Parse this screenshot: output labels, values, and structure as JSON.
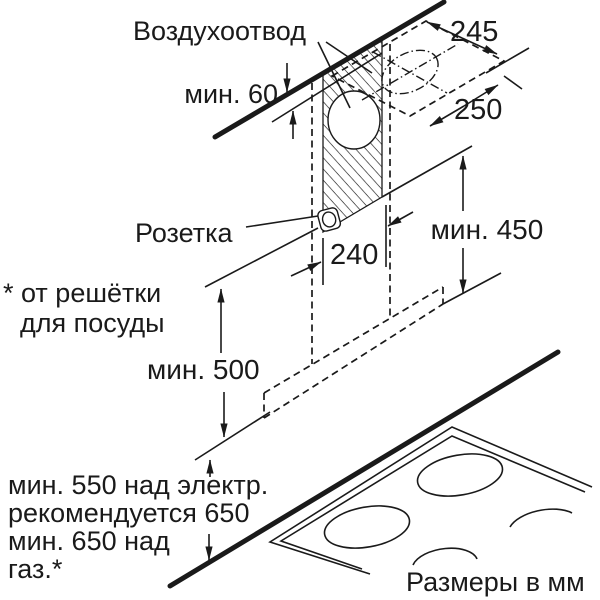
{
  "labels": {
    "air_outlet": "Воздухоотвод",
    "socket": "Розетка",
    "min60": "мин. 60",
    "dim245": "245",
    "dim250": "250",
    "dim240": "240",
    "min450": "мин. 450",
    "min500": "мин. 500",
    "footnote_line1": "* от решётки",
    "footnote_line2": "для посуды",
    "clearance_line1": "мин. 550 над электр.",
    "clearance_line2": "рекомендуется 650",
    "clearance_line3": "мин. 650 над",
    "clearance_line4": "газ.*",
    "units": "Размеры в мм"
  },
  "colors": {
    "ink": "#1a1a1a",
    "background": "#ffffff"
  }
}
